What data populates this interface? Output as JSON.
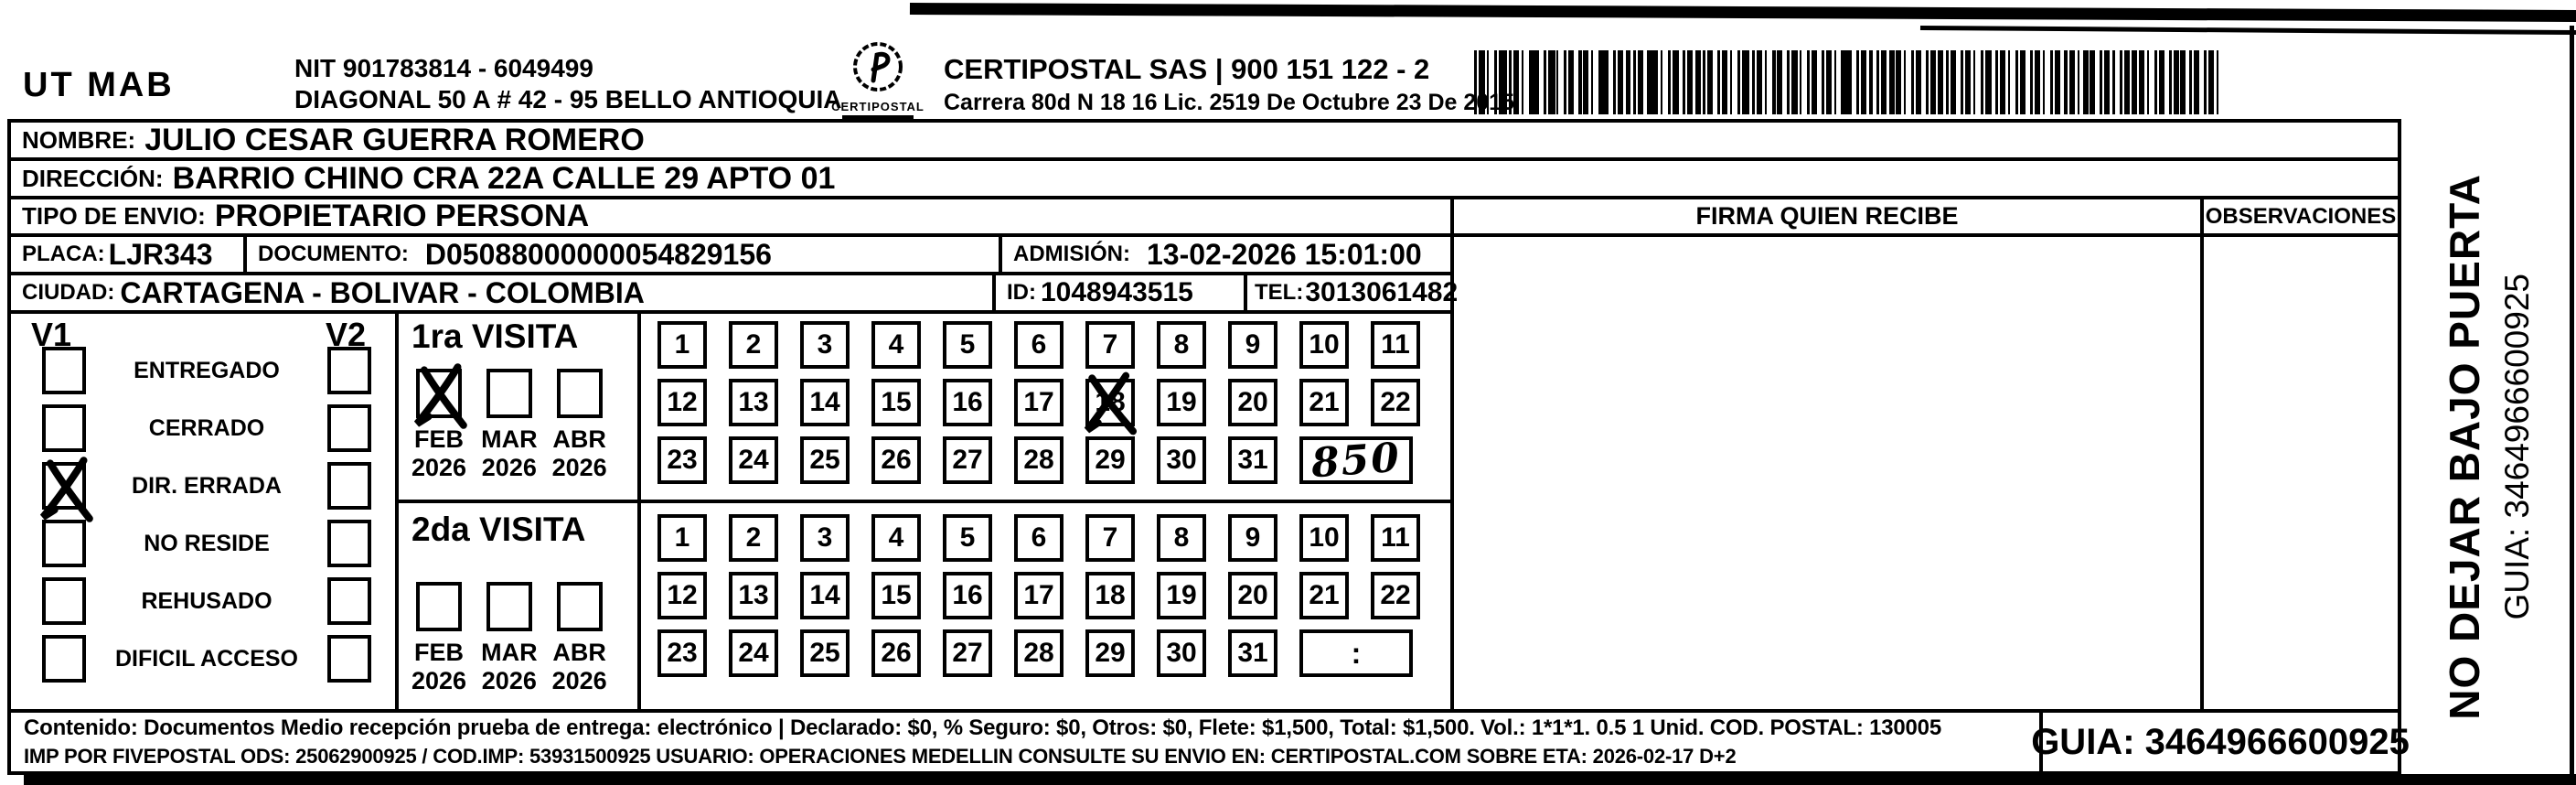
{
  "page": {
    "paper": "#ffffff",
    "ink": "#000000"
  },
  "header": {
    "origin_code": "UT MAB",
    "nit_line1": "NIT 901783814 - 6049499",
    "address_line": "DIAGONAL 50 A # 42 - 95  BELLO  ANTIOQUIA",
    "logo_text": "CERTIPOSTAL",
    "company_line1": "CERTIPOSTAL SAS | 900 151 122 - 2",
    "company_line2": "Carrera 80d N 18 16  Lic. 2519 De Octubre 23 De 2015"
  },
  "shipment": {
    "nombre_label": "NOMBRE:",
    "nombre": "JULIO CESAR GUERRA ROMERO",
    "direccion_label": "DIRECCIÓN:",
    "direccion": "BARRIO CHINO CRA 22A CALLE 29 APTO 01",
    "tipo_label": "TIPO DE ENVIO:",
    "tipo": "PROPIETARIO PERSONA",
    "placa_label": "PLACA:",
    "placa": "LJR343",
    "documento_label": "DOCUMENTO:",
    "documento": "D05088000000054829156",
    "admision_label": "ADMISIÓN:",
    "admision": "13-02-2026 15:01:00",
    "ciudad_label": "CIUDAD:",
    "ciudad": "CARTAGENA - BOLIVAR - COLOMBIA",
    "id_label": "ID:",
    "id_value": "1048943515",
    "tel_label": "TEL:",
    "tel": "3013061482"
  },
  "right_panel": {
    "firma_header": "FIRMA QUIEN RECIBE",
    "observaciones_header": "OBSERVACIONES"
  },
  "status": {
    "v1_label": "V1",
    "v2_label": "V2",
    "options": [
      {
        "label": "ENTREGADO",
        "v1_checked": false,
        "v2_checked": false
      },
      {
        "label": "CERRADO",
        "v1_checked": false,
        "v2_checked": false
      },
      {
        "label": "DIR. ERRADA",
        "v1_checked": true,
        "v2_checked": false
      },
      {
        "label": "NO RESIDE",
        "v1_checked": false,
        "v2_checked": false
      },
      {
        "label": "REHUSADO",
        "v1_checked": false,
        "v2_checked": false
      },
      {
        "label": "DIFICIL ACCESO",
        "v1_checked": false,
        "v2_checked": false
      }
    ]
  },
  "visits": [
    {
      "title": "1ra VISITA",
      "months": [
        {
          "month": "FEB",
          "year": "2026",
          "checked": true
        },
        {
          "month": "MAR",
          "year": "2026",
          "checked": false
        },
        {
          "month": "ABR",
          "year": "2026",
          "checked": false
        }
      ],
      "day_rows": [
        [
          1,
          2,
          3,
          4,
          5,
          6,
          7,
          8,
          9,
          10,
          11
        ],
        [
          12,
          13,
          14,
          15,
          16,
          17,
          18,
          19,
          20,
          21,
          22
        ],
        [
          23,
          24,
          25,
          26,
          27,
          28,
          29,
          30,
          31
        ]
      ],
      "crossed_day": 18,
      "end_box": {
        "kind": "handwriting",
        "text": "850"
      }
    },
    {
      "title": "2da VISITA",
      "months": [
        {
          "month": "FEB",
          "year": "2026",
          "checked": false
        },
        {
          "month": "MAR",
          "year": "2026",
          "checked": false
        },
        {
          "month": "ABR",
          "year": "2026",
          "checked": false
        }
      ],
      "day_rows": [
        [
          1,
          2,
          3,
          4,
          5,
          6,
          7,
          8,
          9,
          10,
          11
        ],
        [
          12,
          13,
          14,
          15,
          16,
          17,
          18,
          19,
          20,
          21,
          22
        ],
        [
          23,
          24,
          25,
          26,
          27,
          28,
          29,
          30,
          31
        ]
      ],
      "crossed_day": null,
      "end_box": {
        "kind": "time",
        "text": ":"
      }
    }
  ],
  "side_note": {
    "warning": "NO DEJAR BAJO PUERTA",
    "guia": "GUIA: 3464966600925"
  },
  "footer": {
    "line1": "Contenido: Documentos Medio recepción prueba de entrega: electrónico | Declarado: $0, % Seguro: $0, Otros: $0, Flete: $1,500, Total: $1,500. Vol.: 1*1*1. 0.5  1 Unid. COD. POSTAL: 130005",
    "line2": "IMP POR FIVEPOSTAL ODS: 25062900925 / COD.IMP: 53931500925 USUARIO: OPERACIONES MEDELLIN CONSULTE SU ENVIO EN: CERTIPOSTAL.COM SOBRE ETA: 2026-02-17 D+2",
    "guia_box": "GUIA: 3464966600925"
  }
}
